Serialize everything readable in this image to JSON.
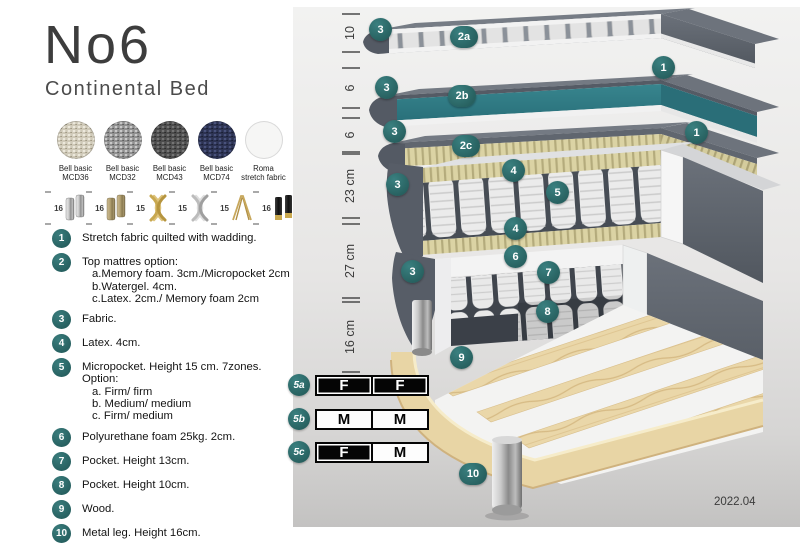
{
  "header": {
    "title": "No6",
    "subtitle": "Continental Bed"
  },
  "swatches": [
    {
      "line1": "Bell basic",
      "line2": "MCD36",
      "color": "#cfc9b8"
    },
    {
      "line1": "Bell basic",
      "line2": "MCD32",
      "color": "#909090"
    },
    {
      "line1": "Bell basic",
      "line2": "MCD43",
      "color": "#4c4c4c"
    },
    {
      "line1": "Bell basic",
      "line2": "MCD74",
      "color": "#2c3251"
    },
    {
      "line1": "Roma",
      "line2": "stretch fabric",
      "color": "#f6f6f5"
    }
  ],
  "leg_options": [
    {
      "height": "16",
      "finish": "chrome-cylinder"
    },
    {
      "height": "16",
      "finish": "bronze-cylinder"
    },
    {
      "height": "15",
      "finish": "gold-cross"
    },
    {
      "height": "15",
      "finish": "silver-cross"
    },
    {
      "height": "15",
      "finish": "gold-hairpin"
    },
    {
      "height": "16",
      "finish": "black-gold-cylinder"
    }
  ],
  "legend": [
    {
      "num": "1",
      "text": "Stretch fabric quilted with wadding."
    },
    {
      "num": "2",
      "text": "Top mattres option:",
      "sub": [
        "a.Memory foam. 3cm./Micropocket 2cm",
        "b.Watergel. 4cm.",
        "c.Latex. 2cm./ Memory foam 2cm"
      ]
    },
    {
      "num": "3",
      "text": "Fabric."
    },
    {
      "num": "4",
      "text": "Latex. 4cm."
    },
    {
      "num": "5",
      "text": "Micropocket. Height 15 cm. 7zones. Option:",
      "sub": [
        "a. Firm/ firm",
        "b. Medium/ medium",
        "c. Firm/ medium"
      ]
    },
    {
      "num": "6",
      "text": "Polyurethane foam 25kg. 2cm."
    },
    {
      "num": "7",
      "text": "Pocket. Height 13cm."
    },
    {
      "num": "8",
      "text": "Pocket. Height 10cm."
    },
    {
      "num": "9",
      "text": "Wood."
    },
    {
      "num": "10",
      "text": "Metal leg. Height 16cm."
    }
  ],
  "diagram": {
    "dimensions": [
      "10",
      "6",
      "6",
      "23 cm",
      "27 cm",
      "16 cm"
    ],
    "markers": [
      "3",
      "2a",
      "1",
      "3",
      "2b",
      "3",
      "2c",
      "1",
      "3",
      "4",
      "5",
      "4",
      "6",
      "3",
      "7",
      "8",
      "9",
      "10"
    ],
    "firmness": {
      "rows": [
        {
          "id": "5a",
          "cells": [
            {
              "label": "F",
              "filled": true
            },
            {
              "label": "F",
              "filled": true
            }
          ]
        },
        {
          "id": "5b",
          "cells": [
            {
              "label": "M",
              "filled": false
            },
            {
              "label": "M",
              "filled": false
            }
          ]
        },
        {
          "id": "5c",
          "cells": [
            {
              "label": "F",
              "filled": true
            },
            {
              "label": "M",
              "filled": false
            }
          ]
        }
      ]
    },
    "version": "2022.04"
  },
  "colors": {
    "accent_teal": "#2d6e6e",
    "layer_teal_core": "#2f7b84",
    "fabric_gray": "#5a616b",
    "latex_tan": "#d9d2a6",
    "wood": "#e8d5a7"
  }
}
